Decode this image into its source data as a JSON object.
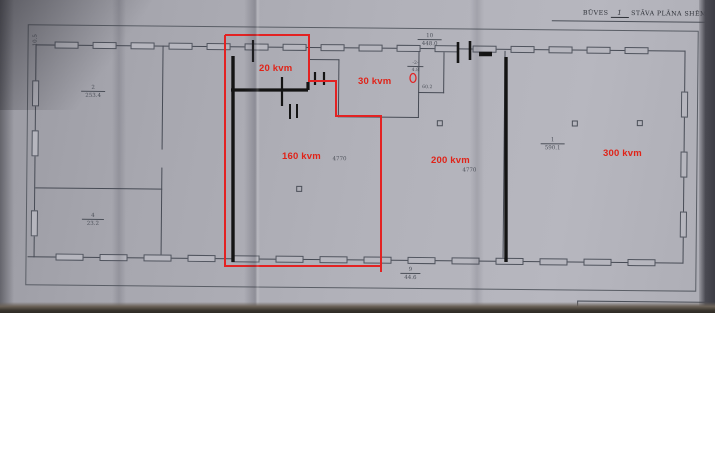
{
  "photo": {
    "header": {
      "prefix": "BŪVES",
      "floor_number": "1",
      "suffix": "STĀVA PLĀNA SHĒMA"
    },
    "footer": {
      "label": "Būves kadastra apzīmējums:",
      "entries": [
        "~~~",
        "~~",
        "~~~",
        "~~"
      ]
    },
    "red_annotations": {
      "color": "#e02318",
      "labels": [
        {
          "text": "20 kvm"
        },
        {
          "text": "30 kvm"
        },
        {
          "text": "160 kvm"
        },
        {
          "text": "200 kvm"
        },
        {
          "text": "300 kvm"
        }
      ]
    },
    "pencil_annotations": {
      "fractions": [
        {
          "num": "2",
          "den": "253.4"
        },
        {
          "num": "4",
          "den": "23.2"
        },
        {
          "num": "1",
          "den": "590.1"
        },
        {
          "num": "10",
          "den": "448.0"
        },
        {
          "num": "9",
          "den": "44.6"
        },
        {
          "num": "-2-",
          "den": "4.8"
        }
      ],
      "plain": [
        {
          "text": "4770"
        },
        {
          "text": "4770"
        },
        {
          "text": "60.2"
        },
        {
          "text": "10.5"
        }
      ]
    }
  }
}
